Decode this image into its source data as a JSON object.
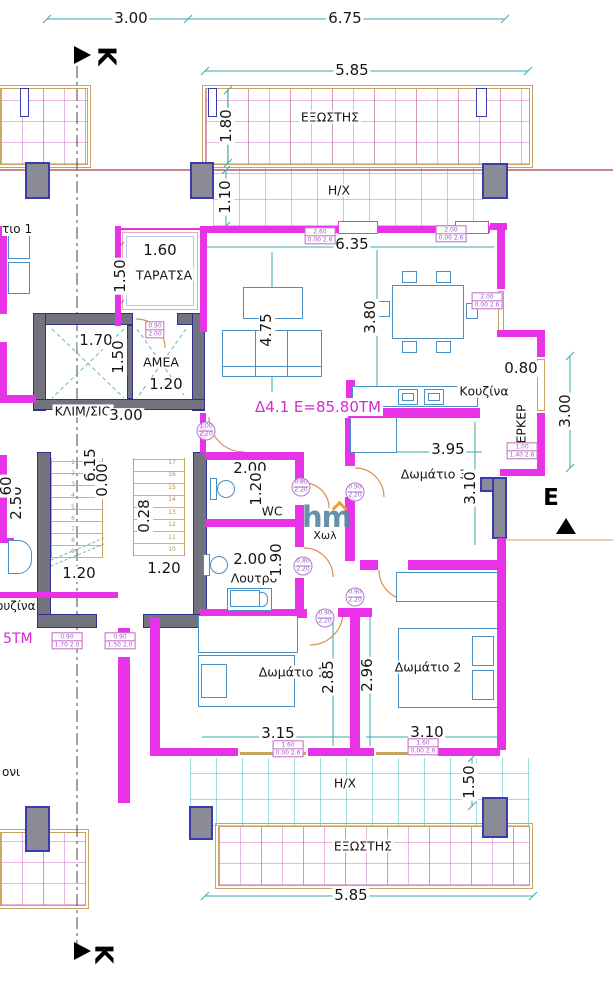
{
  "apartment": {
    "label": "Δ4.1 Ε=85.80ΤΜ"
  },
  "section_markers": {
    "top": "Κ",
    "bottom": "Κ",
    "right": "Ε"
  },
  "rooms": {
    "exostis_top": "ΕΞΩΣΤΗΣ",
    "hx_top": "Η/Χ",
    "taratsa": "ΤΑΡΑΤΣΑ",
    "amea": "ΑΜΕΑ",
    "klimsio": "ΚΛΙΜ/ΣΙΟ",
    "kouzina": "Κουζίνα",
    "erker": "ΕΡΚΕΡ",
    "room3": "Δωμάτιο 3",
    "wc": "WC",
    "hall": "Χωλ",
    "loutro": "Λουτρό",
    "room1": "Δωμάτιο 1",
    "room2": "Δωμάτιο 2",
    "hx_bottom": "Η/Χ",
    "exostis_bottom": "ΕΞΩΣΤΗΣ"
  },
  "dims": {
    "top_w1": "3.00",
    "top_w2": "6.75",
    "balc_top": "5.85",
    "balc_depth": "1.80",
    "hx_depth": "1.10",
    "taratsa_w": "1.60",
    "taratsa_h": "1.50",
    "living_w": "6.35",
    "living_h": "4.75",
    "dining_h": "3.80",
    "void_w": "1.70",
    "lift_h": "1.50",
    "lift_w": "1.20",
    "klim_w": "3.00",
    "erker_d": "0.80",
    "erker_h": "3.00",
    "room3_w": "3.95",
    "room3_h": "3.10",
    "stair_lvl": "6.15",
    "stair_lvl0": "0.00",
    "stair_d": "0.28",
    "stair_w1": "1.20",
    "stair_w2": "1.20",
    "adj_h": "2.50",
    "adj_frag": "60",
    "wc_w": "2.00",
    "wc_h": "1.20",
    "loutro_w": "2.00",
    "loutro_h": "1.90",
    "room1_h": "2.85",
    "room2_h": "2.96",
    "room1_w": "3.15",
    "room2_w": "3.10",
    "hx_bot_h": "1.50",
    "balc_bot": "5.85"
  },
  "fragments": {
    "room_adj": "τιο 1",
    "kouzina_adj": "ουζίνα",
    "area_adj": "5ΤΜ",
    "balcony_adj": "ονι"
  },
  "door_tags": {
    "d1": {
      "a": "1.00",
      "b": "2.20"
    },
    "d2": {
      "a": "0.80",
      "b": "2.20"
    },
    "d3": {
      "a": "0.90",
      "b": "2.20"
    },
    "d4": {
      "a": "0.80",
      "b": "2.20"
    },
    "d5": {
      "a": "0.90",
      "b": "2.20"
    },
    "d6": {
      "a": "0.90",
      "b": "2.20"
    }
  },
  "window_tags": {
    "w1": {
      "a": "2.60",
      "b": "0.00 2.6"
    },
    "w2": {
      "a": "2.00",
      "b": "0.00 2.6"
    },
    "w3": {
      "a": "1.00",
      "b": "1.40 2.6"
    },
    "w4": {
      "a": "2.00",
      "b": "0.00 2.6"
    },
    "w5": {
      "a": "1.60",
      "b": "0.00 2.6"
    },
    "w6": {
      "a": "1.60",
      "b": "0.00 2.6"
    },
    "w7": {
      "a": "0.90",
      "b": "1.70 2.0"
    },
    "w8": {
      "a": "0.90",
      "b": "1.50 2.0"
    },
    "w9": {
      "a": "0.90",
      "b": "2.00"
    }
  },
  "stairs": {
    "right": [
      "17",
      "16",
      "15",
      "14",
      "13",
      "12",
      "11",
      "10"
    ],
    "left": [
      "1",
      "2",
      "3",
      "4",
      "5",
      "6",
      "7",
      "8",
      "9"
    ]
  },
  "watermark": {
    "text": "hm"
  },
  "colors": {
    "wall_magenta": "#e832e8",
    "column_blue": "#3b3bb0",
    "dimension_teal": "#3aabab",
    "furniture_blue": "#4a90c4",
    "hatch_tan": "#c9a362",
    "label_magenta": "#d42ad4"
  }
}
